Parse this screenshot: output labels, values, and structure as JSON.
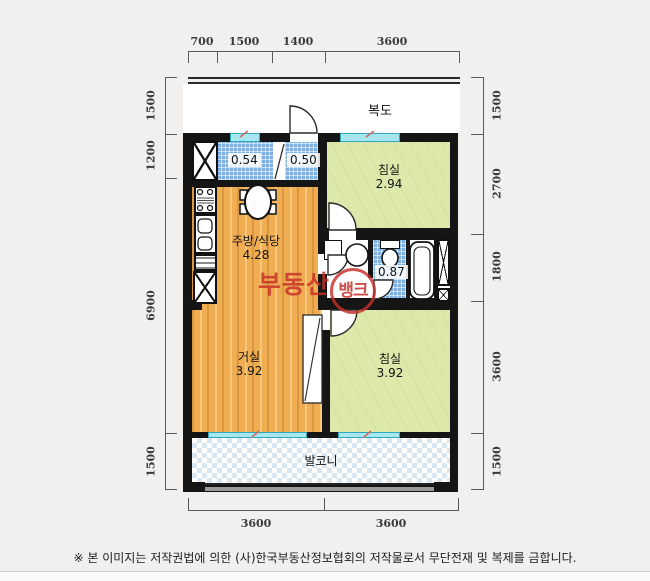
{
  "plan": {
    "corridor_label": "복도",
    "balcony_label": "발코니",
    "rooms": {
      "utility": {
        "area": "0.54"
      },
      "entry": {
        "area": "0.50"
      },
      "bedroom1": {
        "name": "침실",
        "area": "2.94"
      },
      "kitchen": {
        "name": "주방/식당",
        "area": "4.28"
      },
      "bathroom": {
        "area": "0.87"
      },
      "living": {
        "name": "거실",
        "area": "3.92"
      },
      "bedroom2": {
        "name": "침실",
        "area": "3.92"
      }
    }
  },
  "dimensions": {
    "top": [
      "700",
      "1500",
      "1400",
      "3600"
    ],
    "left": [
      "1500",
      "1200",
      "6900",
      "1500"
    ],
    "right": [
      "1500",
      "2700",
      "1800",
      "3600",
      "1500"
    ],
    "bottom": [
      "3600",
      "3600"
    ]
  },
  "watermark": {
    "text": "부동산",
    "badge": "뱅크"
  },
  "footer": {
    "copyright": "※ 본 이미지는 저작권법에 의한 (사)한국부동산정보협회의 저작물로서 무단전재 및 복제를 금합니다."
  },
  "colors": {
    "wall": "#151515",
    "wood": "#f0ad52",
    "bedroom_green": "#dde8ab",
    "bath_tile": "#7fb0e2",
    "window_cyan": "#a5e6ef",
    "balcony_check": "#d9e6ef",
    "watermark_red": "#c62e28",
    "background": "#f2f0ee"
  }
}
